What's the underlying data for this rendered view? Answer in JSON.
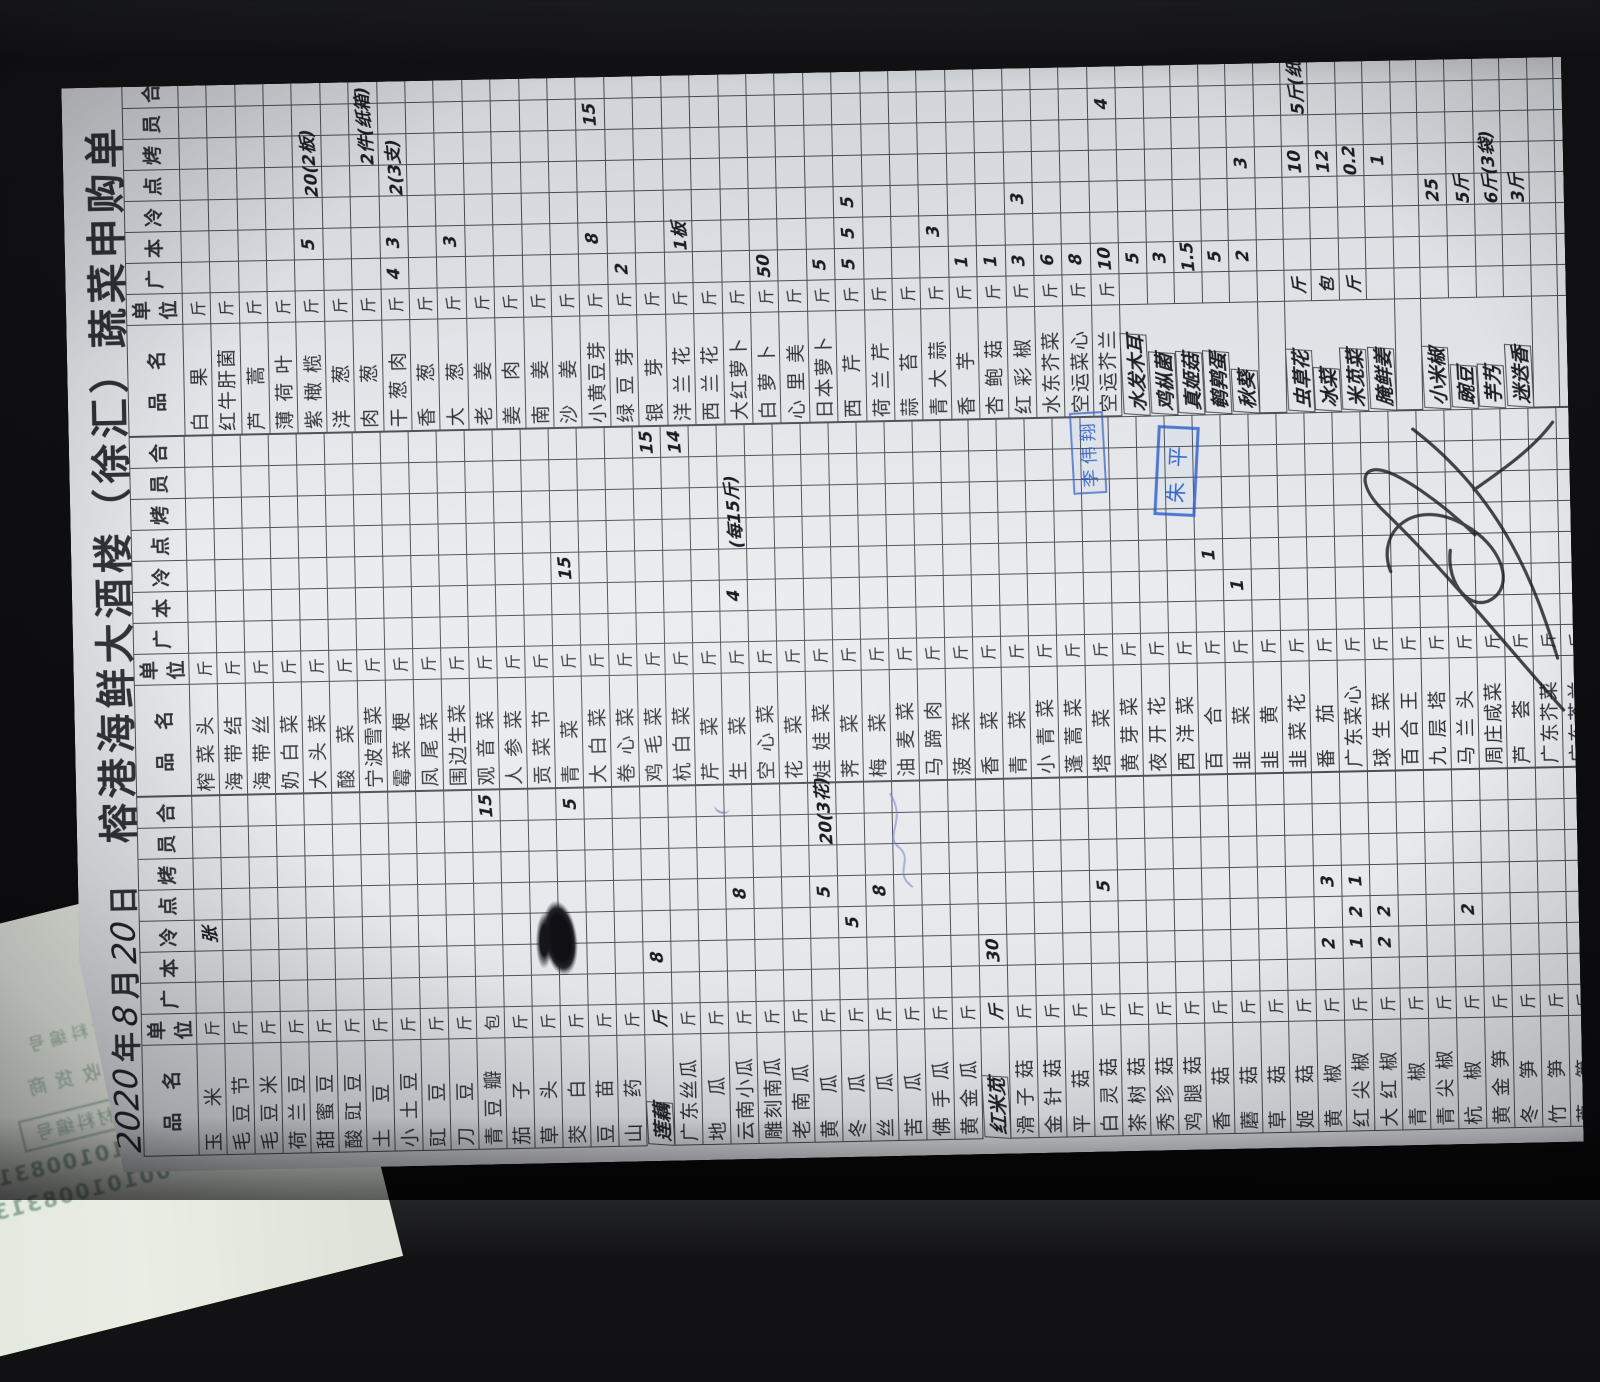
{
  "title": "榕港海鲜大酒楼（徐汇）蔬菜申购单",
  "date": {
    "year": "2020",
    "year_label": "年",
    "month": "8",
    "month_label": "月",
    "day": "20",
    "day_label": "日"
  },
  "columns": [
    "品　名",
    "单位",
    "广",
    "本",
    "冷",
    "点",
    "烤",
    "员",
    "合"
  ],
  "unit_default": "斤",
  "qty_column_keys": [
    "guang",
    "ben",
    "leng",
    "dian",
    "kao",
    "yuan",
    "he"
  ],
  "colors": {
    "stamp_blue": "#2d5fc8",
    "pen_black": "#1b1c22",
    "paper": "#e4e7ea",
    "ghost_green": "#7d9c86"
  },
  "stamps": [
    {
      "text": "李伟翔"
    },
    {
      "text": "朱平"
    }
  ],
  "under_paper": {
    "ghost_lines": [
      "材料编号",
      "收货商"
    ],
    "box_label": "材料编号",
    "codes": [
      "0010100831",
      "00101008313"
    ]
  },
  "groups": [
    {
      "items": [
        {
          "n": "玉米",
          "q": {
            "leng": "张"
          }
        },
        {
          "n": "毛豆节"
        },
        {
          "n": "毛豆米"
        },
        {
          "n": "荷兰豆"
        },
        {
          "n": "甜蜜豆"
        },
        {
          "n": "酸豇豆"
        },
        {
          "n": "土豆"
        },
        {
          "n": "小土豆"
        },
        {
          "n": "豇豆"
        },
        {
          "n": "刀豆"
        },
        {
          "n": "青豆瓣",
          "u": "包",
          "q": {
            "he": "15"
          }
        },
        {
          "n": "茄子"
        },
        {
          "n": "草头"
        },
        {
          "n": "茭白",
          "q": {
            "he": "5"
          }
        },
        {
          "n": "豆苗"
        },
        {
          "n": "山药"
        },
        {
          "n": "莲藕",
          "hw": 1,
          "q": {
            "ben": "8"
          }
        },
        {
          "n": "广东丝瓜"
        },
        {
          "n": "地瓜"
        },
        {
          "n": "云南小瓜",
          "q": {
            "dian": "8"
          }
        },
        {
          "n": "雕刻南瓜"
        },
        {
          "n": "老南瓜"
        },
        {
          "n": "黄瓜",
          "q": {
            "dian": "5",
            "yuan": "20(3花)"
          }
        },
        {
          "n": "冬瓜",
          "q": {
            "leng": "5"
          }
        },
        {
          "n": "丝瓜",
          "q": {
            "dian": "8"
          }
        },
        {
          "n": "苦瓜"
        },
        {
          "n": "佛手瓜"
        },
        {
          "n": "黄金瓜"
        },
        {
          "n": "红米苋",
          "hw": 1,
          "q": {
            "ben": "30"
          }
        },
        {
          "n": "滑子菇"
        },
        {
          "n": "金针菇"
        },
        {
          "n": "平菇"
        },
        {
          "n": "白灵菇",
          "q": {
            "dian": "5"
          }
        },
        {
          "n": "茶树菇"
        },
        {
          "n": "秀珍菇"
        },
        {
          "n": "鸡腿菇"
        },
        {
          "n": "香菇"
        },
        {
          "n": "蘑菇"
        },
        {
          "n": "草菇"
        },
        {
          "n": "姬菇"
        },
        {
          "n": "黄椒",
          "q": {
            "dian": "3",
            "ben": "2"
          }
        },
        {
          "n": "红尖椒",
          "q": {
            "dian": "1",
            "leng": "2",
            "ben": "1"
          }
        },
        {
          "n": "大红椒",
          "q": {
            "leng": "2",
            "ben": "2"
          }
        },
        {
          "n": "青椒"
        },
        {
          "n": "青尖椒"
        },
        {
          "n": "杭椒",
          "q": {
            "leng": "2"
          }
        },
        {
          "n": "黄金笋"
        },
        {
          "n": "冬笋"
        },
        {
          "n": "竹笋"
        },
        {
          "n": "芦笋"
        },
        {
          "n": "香乌笋"
        },
        {
          "n": "水笋"
        },
        {}
      ]
    },
    {
      "items": [
        {
          "n": "榨菜头"
        },
        {
          "n": "海带结"
        },
        {
          "n": "海带丝"
        },
        {
          "n": "奶白菜"
        },
        {
          "n": "大头菜"
        },
        {
          "n": "酸菜"
        },
        {
          "n": "宁波雪菜"
        },
        {
          "n": "霉菜梗"
        },
        {
          "n": "凤尾菜"
        },
        {
          "n": "围边生菜"
        },
        {
          "n": "观音菜"
        },
        {
          "n": "人参菜"
        },
        {
          "n": "贡菜节"
        },
        {
          "n": "青菜",
          "q": {
            "leng": "15"
          }
        },
        {
          "n": "大白菜"
        },
        {
          "n": "卷心菜"
        },
        {
          "n": "鸡毛菜",
          "q": {
            "he": "15"
          }
        },
        {
          "n": "杭白菜",
          "q": {
            "he": "14"
          }
        },
        {
          "n": "芹菜"
        },
        {
          "n": "生菜",
          "q": {
            "ben": "4",
            "dian": "(每15斤)"
          }
        },
        {
          "n": "空心菜"
        },
        {
          "n": "花菜"
        },
        {
          "n": "娃娃菜"
        },
        {
          "n": "荠菜"
        },
        {
          "n": "梅菜"
        },
        {
          "n": "油麦菜"
        },
        {
          "n": "马蹄肉"
        },
        {
          "n": "菠菜"
        },
        {
          "n": "香菜"
        },
        {
          "n": "青菜"
        },
        {
          "n": "小青菜"
        },
        {
          "n": "蓬蒿菜"
        },
        {
          "n": "塔菜"
        },
        {
          "n": "黄芽菜"
        },
        {
          "n": "夜开花"
        },
        {
          "n": "西洋菜"
        },
        {
          "n": "百合",
          "q": {
            "leng": "1"
          }
        },
        {
          "n": "韭菜",
          "q": {
            "ben": "1"
          }
        },
        {
          "n": "韭黄"
        },
        {
          "n": "韭菜花"
        },
        {
          "n": "番茄"
        },
        {
          "n": "广东菜心"
        },
        {
          "n": "球生菜"
        },
        {
          "n": "百合王"
        },
        {
          "n": "九层塔"
        },
        {
          "n": "马兰头"
        },
        {
          "n": "周庄咸菜"
        },
        {
          "n": "芦荟"
        },
        {
          "n": "广东芥菜"
        },
        {
          "n": "广东芥兰"
        },
        {
          "n": "细芥兰"
        },
        {
          "n": "紫芥兰"
        },
        {}
      ]
    },
    {
      "items": [
        {
          "n": "白果"
        },
        {
          "n": "红牛肝菌"
        },
        {
          "n": "芦蒿"
        },
        {
          "n": "薄荷叶"
        },
        {
          "n": "紫橄榄",
          "q": {
            "ben": "5",
            "dian": "20(2板)"
          }
        },
        {
          "n": "洋葱"
        },
        {
          "n": "肉葱",
          "q": {
            "kao": "2件(纸箱)"
          }
        },
        {
          "n": "干葱肉",
          "q": {
            "guang": "4",
            "ben": "3",
            "dian": "2(3支)"
          }
        },
        {
          "n": "香葱"
        },
        {
          "n": "大葱",
          "q": {
            "ben": "3"
          }
        },
        {
          "n": "老姜"
        },
        {
          "n": "姜肉"
        },
        {
          "n": "南姜"
        },
        {
          "n": "沙姜"
        },
        {
          "n": "小黄豆芽",
          "q": {
            "ben": "8",
            "yuan": "15"
          }
        },
        {
          "n": "绿豆芽",
          "q": {
            "guang": "2"
          }
        },
        {
          "n": "银芽"
        },
        {
          "n": "洋兰花",
          "q": {
            "ben": "1板"
          }
        },
        {
          "n": "西兰花"
        },
        {
          "n": "大红萝卜"
        },
        {
          "n": "白萝卜",
          "q": {
            "guang": "50"
          }
        },
        {
          "n": "心里美"
        },
        {
          "n": "日本萝卜",
          "q": {
            "guang": "5"
          }
        },
        {
          "n": "西芹",
          "q": {
            "leng": "5",
            "ben": "5",
            "guang": "5"
          }
        },
        {
          "n": "荷兰芹"
        },
        {
          "n": "蒜苔"
        },
        {
          "n": "青大蒜",
          "q": {
            "ben": "3"
          }
        },
        {
          "n": "香芋",
          "q": {
            "guang": "1"
          }
        },
        {
          "n": "杏鲍菇",
          "q": {
            "guang": "1"
          }
        },
        {
          "n": "红彩椒",
          "q": {
            "leng": "3",
            "guang": "3"
          }
        },
        {
          "n": "水东芥菜",
          "q": {
            "guang": "6"
          }
        },
        {
          "n": "空运菜心",
          "q": {
            "guang": "8"
          }
        },
        {
          "n": "空运芥兰",
          "q": {
            "guang": "10",
            "yuan": "4"
          }
        },
        {
          "n": "水发木耳",
          "hw": 1,
          "u": "",
          "q": {
            "guang": "5"
          }
        },
        {
          "n": "鸡枞菌",
          "hw": 1,
          "u": "",
          "q": {
            "guang": "3"
          }
        },
        {
          "n": "真姬菇",
          "hw": 1,
          "u": "",
          "q": {
            "guang": "1.5"
          }
        },
        {
          "n": "鹌鹑蛋",
          "hw": 1,
          "u": "",
          "q": {
            "guang": "5"
          }
        },
        {
          "n": "秋葵",
          "hw": 1,
          "u": "",
          "q": {
            "dian": "3",
            "guang": "2"
          }
        },
        {},
        {
          "n": "虫草花",
          "hw": 1,
          "u": "斤",
          "q": {
            "dian": "10",
            "yuan": "5斤(纸箱)"
          }
        },
        {
          "n": "冰菜",
          "hw": 1,
          "u": "包",
          "q": {
            "dian": "12"
          }
        },
        {
          "n": "米苋菜",
          "hw": 1,
          "u": "斤",
          "q": {
            "dian": "0.2"
          }
        },
        {
          "n": "腌鲜姜",
          "hw": 1,
          "u": "",
          "q": {
            "dian": "1"
          }
        },
        {},
        {
          "n": "小米椒",
          "hw": 1,
          "u": "",
          "q": {
            "leng": "25"
          }
        },
        {
          "n": "豌豆",
          "hw": 1,
          "u": "",
          "q": {
            "leng": "5斤"
          }
        },
        {
          "n": "芋艿",
          "hw": 1,
          "u": "",
          "q": {
            "leng": "6斤(3袋)"
          }
        },
        {
          "n": "迷迭香",
          "hw": 1,
          "u": "",
          "q": {
            "leng": "3斤"
          }
        },
        {},
        {},
        {},
        {},
        {}
      ]
    }
  ]
}
